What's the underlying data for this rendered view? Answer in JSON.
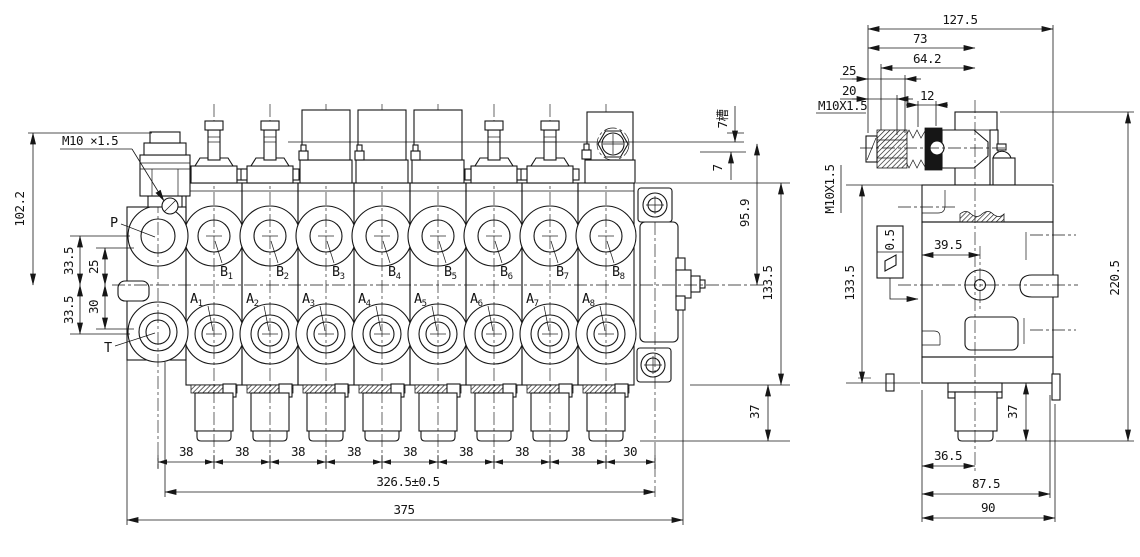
{
  "page": {
    "background": "#ffffff",
    "line_color": "#161616"
  },
  "left_view": {
    "thread_callout": "M10 ×1.5",
    "labels": {
      "p": "P",
      "t": "T"
    },
    "b_ports": [
      {
        "b": "B",
        "s": "1"
      },
      {
        "b": "B",
        "s": "2"
      },
      {
        "b": "B",
        "s": "3"
      },
      {
        "b": "B",
        "s": "4"
      },
      {
        "b": "B",
        "s": "5"
      },
      {
        "b": "B",
        "s": "6"
      },
      {
        "b": "B",
        "s": "7"
      },
      {
        "b": "B",
        "s": "8"
      }
    ],
    "a_ports": [
      {
        "b": "A",
        "s": "1"
      },
      {
        "b": "A",
        "s": "2"
      },
      {
        "b": "A",
        "s": "3"
      },
      {
        "b": "A",
        "s": "4"
      },
      {
        "b": "A",
        "s": "5"
      },
      {
        "b": "A",
        "s": "6"
      },
      {
        "b": "A",
        "s": "7"
      },
      {
        "b": "A",
        "s": "8"
      }
    ],
    "dim_total_height": "102.2",
    "dim_p_offset": "33.5",
    "dim_p_inner": "25",
    "dim_t_offset": "33.5",
    "dim_t_inner": "30",
    "dim_slot_depth": "7槽",
    "dim_slot_lower": "7",
    "dim_body_height": "95.9",
    "dim_height_133": "133.5",
    "dim_plug_height": "37",
    "pitch_dims": [
      "38",
      "38",
      "38",
      "38",
      "38",
      "38",
      "38",
      "38"
    ],
    "dim_end_pitch": "30",
    "dim_span": "326.5±0.5",
    "dim_total_width": "375"
  },
  "side_view": {
    "dim_total_depth": "127.5",
    "dim_73": "73",
    "dim_64": "64.2",
    "dim_25": "25",
    "dim_20": "20",
    "thread_callout_top": "M10X1.5",
    "dim_12": "12",
    "thread_callout_side": "M10X1.5",
    "dim_133": "133.5",
    "flatness_value": "0.5",
    "dim_39": "39.5",
    "dim_height": "220.5",
    "dim_37": "37",
    "dim_36": "36.5",
    "dim_87": "87.5",
    "dim_90": "90"
  }
}
